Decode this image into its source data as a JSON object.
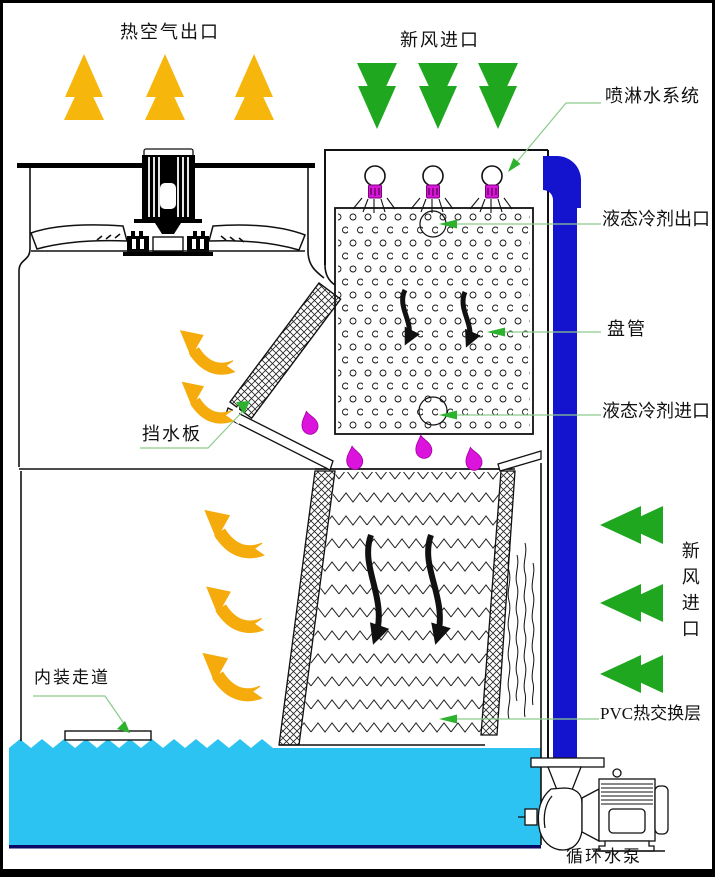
{
  "diagram": {
    "title": "闭式冷却塔结构示意图",
    "labels": {
      "hot_air_outlet": "热空气出口",
      "fresh_air_inlet_top": "新风进口",
      "spray_water_system": "喷淋水系统",
      "liquid_refrigerant_outlet": "液态冷剂出口",
      "coil": "盘管",
      "liquid_refrigerant_inlet": "液态冷剂进口",
      "water_baffle": "挡水板",
      "fresh_air_inlet_right": "新风进口",
      "internal_walkway": "内装走道",
      "pvc_heat_exchange_layer": "PVC热交换层",
      "circulating_water_pump": "循环水泵"
    },
    "colors": {
      "hot_air_arrow_orange": "#F7B60C",
      "exhaust_swoosh_orange": "#F5AB0C",
      "fresh_air_arrow_green": "#1FA71F",
      "pipe_blue": "#1414CE",
      "water_cyan": "#2CC3F2",
      "drop_magenta": "#DC13DC",
      "leader_line_green": "#8CCB8C",
      "leader_arrow_green": "#2EB12E",
      "line_black": "#000000"
    },
    "counts": {
      "hot_air_up_arrows": 3,
      "fresh_air_down_arrows": 3,
      "fresh_air_left_arrows": 3,
      "exhaust_swoosh_arrows_upper": 2,
      "exhaust_swoosh_arrows_lower": 3,
      "sprinklers": 3,
      "coil_flow_arrows": 2,
      "fill_flow_arrows": 2,
      "water_drops": 4
    }
  }
}
